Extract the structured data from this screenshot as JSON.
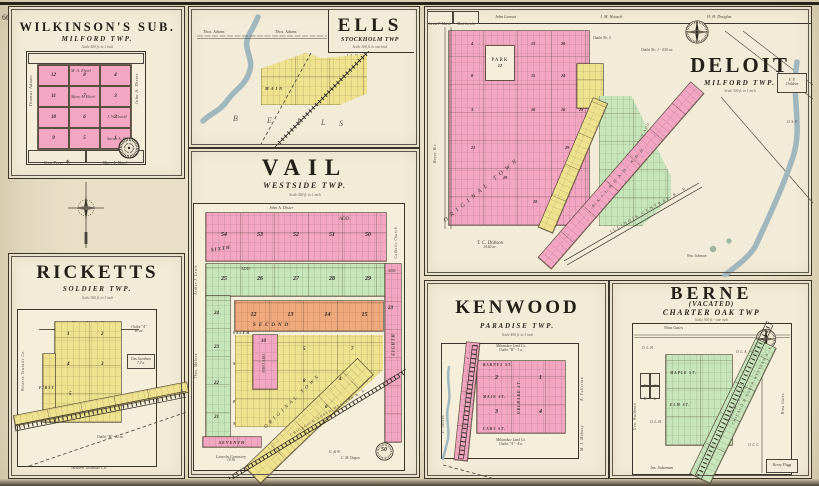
{
  "page": {
    "left_number": "66",
    "right_number": "67"
  },
  "colors": {
    "pink": "#f2a6c2",
    "yellow": "#eee28e",
    "green": "#c6e5ba",
    "orange": "#f0a97c",
    "river": "#9fb7bd",
    "ink": "#322c24",
    "paper": "#f2ebd7"
  },
  "wilkinsons": {
    "title": "WILKINSON'S SUB.",
    "subtitle": "MILFORD TWP.",
    "scale": "Scale 400 ft. to 1 inch",
    "top_owner": "Albert Kral",
    "left_owner": "Thomas Adams",
    "right_owner": "John A. Dister",
    "bottom_owner_1": "Cone Prey",
    "church_glyph": "✝",
    "bottom_owner_2": "Mary A. Ehorl",
    "name_1": "M. A. Ehorl",
    "name_2": "Mary A. Ehorl",
    "name_3": "J. W. Gould",
    "name_4": "Sarah A. Gould",
    "col1": [
      "12",
      "11",
      "10",
      "9"
    ],
    "col2": [
      "8",
      "7",
      "6",
      "5"
    ],
    "col3": [
      "4",
      "3",
      "2",
      "1"
    ]
  },
  "ells": {
    "title": "ELLS",
    "subtitle": "STOCKHOLM TWP",
    "scale": "Scale 300 ft. to one inch",
    "owner": "J. A. Wolf",
    "adams_1": "Thos. Adams",
    "adams_2": "Thos. Adams",
    "main_street": "MAIN",
    "letters": [
      "B",
      "E",
      "L",
      "L",
      "S"
    ]
  },
  "deloit": {
    "title": "DELOIT",
    "subtitle": "MILFORD TWP.",
    "scale": "Scale 300 ft. to 1 inch",
    "owner_1": "Lewis F. Marsh",
    "owner_2": "Matt Jacobs",
    "owner_3": "John Lanout",
    "owner_4": "J. M. Hausch",
    "owner_5": "H. H. Douglas",
    "park": "PARK",
    "park_no": "12",
    "original_town": "ORIGINAL TOWN",
    "blocks": [
      "4",
      "13",
      "20",
      "8",
      "15",
      "24",
      "3",
      "10",
      "16",
      "23",
      "21",
      "19",
      "18",
      "29"
    ],
    "outlot_top": "Outlot No. 5",
    "outlot_title": "Outlot No. 1 - 4.50 ac.",
    "green_add": "WESTERN TOWNLOT CO'S ADD.",
    "rr_add": "RAILROAD ADD.",
    "rr_name": "ILLINOIS CENTRAL R. R.",
    "dobson": "T. C. Dobson",
    "dobson_acres": "34.60 ac.",
    "johnson": "Wm. Johnson",
    "left_margin": "Boyer Riv.",
    "right_box_1": "E. F.",
    "right_box_2": "Children",
    "osf": "O. S. F."
  },
  "vail": {
    "title": "VAIL",
    "subtitle": "WESTSIDE TWP.",
    "scale": "Scale 400 ft. to 1 inch",
    "top_owner": "John A. Dister",
    "add_1": "ADD.",
    "add_2": "ADD.",
    "add_3": "ADD.",
    "pink_blocks": [
      "54",
      "53",
      "52",
      "51",
      "50"
    ],
    "green_blocks": [
      "25",
      "26",
      "27",
      "28",
      "29"
    ],
    "orange_blocks": [
      "12",
      "13",
      "14",
      "15"
    ],
    "right_block": "23",
    "strip_block": "10",
    "left_blocks": [
      "24",
      "23",
      "22",
      "21"
    ],
    "yellow_blocks": [
      "5",
      "8",
      "4",
      "7",
      "6"
    ],
    "st_sixth": "SIXTH",
    "st_fifth": "FIFTH",
    "st_second": "SECOND",
    "st_seventh": "SEVENTH",
    "st_eighth": "EIGHTH",
    "st_first_add": "FIRST ADD.",
    "st_salem": "SALEM",
    "st_middlesex": "MIDDLESEX",
    "st_pleasant": "PLEASANT",
    "st_madison": "MADISON",
    "original_town": "ORIGINAL TOWN",
    "rr_name": "CHICAGO & NORTH-WESTERN R. R.",
    "cemetery": "Lincoln Cemetery",
    "cemetery_acres": "19.36",
    "dugan_1": "G. & W.",
    "dugan_2": "C. M. Dugan",
    "stamp": "50",
    "left_margin_1": "Arthur J. Lewis",
    "left_margin_2": "Thos. Malone",
    "right_margin_1": "Catholic Church",
    "right_margin_2": "Cemetery"
  },
  "ricketts": {
    "title": "RICKETTS",
    "subtitle": "SOLDIER TWP.",
    "scale": "Scale 300 ft. to 1 inch",
    "top_owner": "Western Townlot Co.",
    "bottom_owner": "Western Townsite Co.",
    "left_margin": "Western Townsite Co.",
    "outlot_a_1": "Outlot \"A\"",
    "outlot_a_2": "40 ac.",
    "jacobsen_1": "Gus Jacobsen",
    "jacobsen_2": "7.9 a.",
    "outlot_b": "Outlot \"B\" - 22 ac.",
    "blocks": [
      "1",
      "2",
      "4",
      "3",
      "5"
    ],
    "st_first": "FIRST"
  },
  "kenwood": {
    "title": "KENWOOD",
    "subtitle": "PARADISE TWP.",
    "scale": "Scale 400 ft. to 1 inch",
    "top_label_1": "Milwaukee Land Co.",
    "top_label_2": "Outlot \"B\" - 3 a.",
    "bottom_label_1": "Milwaukee Land Co.",
    "bottom_label_2": "Outlot \"A\" - 4 a.",
    "st_barnes": "BARNES ST.",
    "st_main": "MAIN ST.",
    "st_cary": "CARY ST.",
    "st_orchard": "ORCHARD ST.",
    "blocks": [
      "2",
      "1",
      "3",
      "4"
    ],
    "right_margin_1": "E. Fullerton",
    "right_margin_2": "M. J. Mahony",
    "left_margin": "F. Jacobs"
  },
  "berne": {
    "title": "BERNE",
    "vacated": "(VACATED)",
    "subtitle": "CHARTER OAK TWP",
    "scale": "Scale 300 ft. - one inch",
    "top_owner": "Nina Gates",
    "right_owner": "Nina Gates",
    "left_owner": "Geo. Waldman",
    "bottom_owner": "Jas. Saltzman",
    "flagg": "Henry Flagg",
    "st_maple": "MAPLE ST.",
    "st_elm": "ELM ST.",
    "outlots": [
      "O. L. H.",
      "O. L. A.",
      "O. L. H.",
      "O. L. C."
    ],
    "letters": [
      "F",
      "G",
      "K",
      "L"
    ],
    "rr_name": "CHICAGO & NORTH-WESTERN R. R.",
    "rr_lots": "RAILROAD LOTS"
  }
}
